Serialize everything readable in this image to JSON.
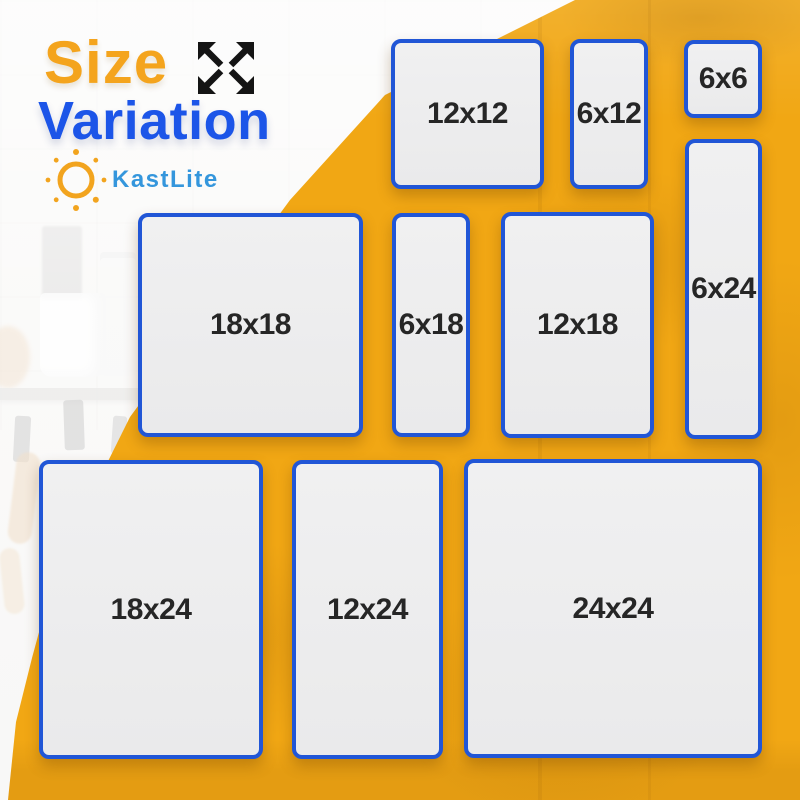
{
  "header": {
    "title_line1": "Size",
    "title_line2": "Variation",
    "brand": "KastLite"
  },
  "icons": {
    "expand": "expand-arrows-icon",
    "logo": "sun-icon"
  },
  "colors": {
    "title_orange": "#F4A41D",
    "title_blue": "#1C55E8",
    "brand_blue": "#3496DC",
    "background_orange": "#F1A714",
    "panel_fill": "#EDEDEE",
    "panel_border": "#2156D6",
    "panel_text": "#262626"
  },
  "panels": [
    {
      "label": "12x12",
      "width_in": 12,
      "height_in": 12
    },
    {
      "label": "6x12",
      "width_in": 6,
      "height_in": 12
    },
    {
      "label": "6x6",
      "width_in": 6,
      "height_in": 6
    },
    {
      "label": "6x24",
      "width_in": 6,
      "height_in": 24
    },
    {
      "label": "18x18",
      "width_in": 18,
      "height_in": 18
    },
    {
      "label": "6x18",
      "width_in": 6,
      "height_in": 18
    },
    {
      "label": "12x18",
      "width_in": 12,
      "height_in": 18
    },
    {
      "label": "18x24",
      "width_in": 18,
      "height_in": 24
    },
    {
      "label": "12x24",
      "width_in": 12,
      "height_in": 24
    },
    {
      "label": "24x24",
      "width_in": 24,
      "height_in": 24
    }
  ]
}
